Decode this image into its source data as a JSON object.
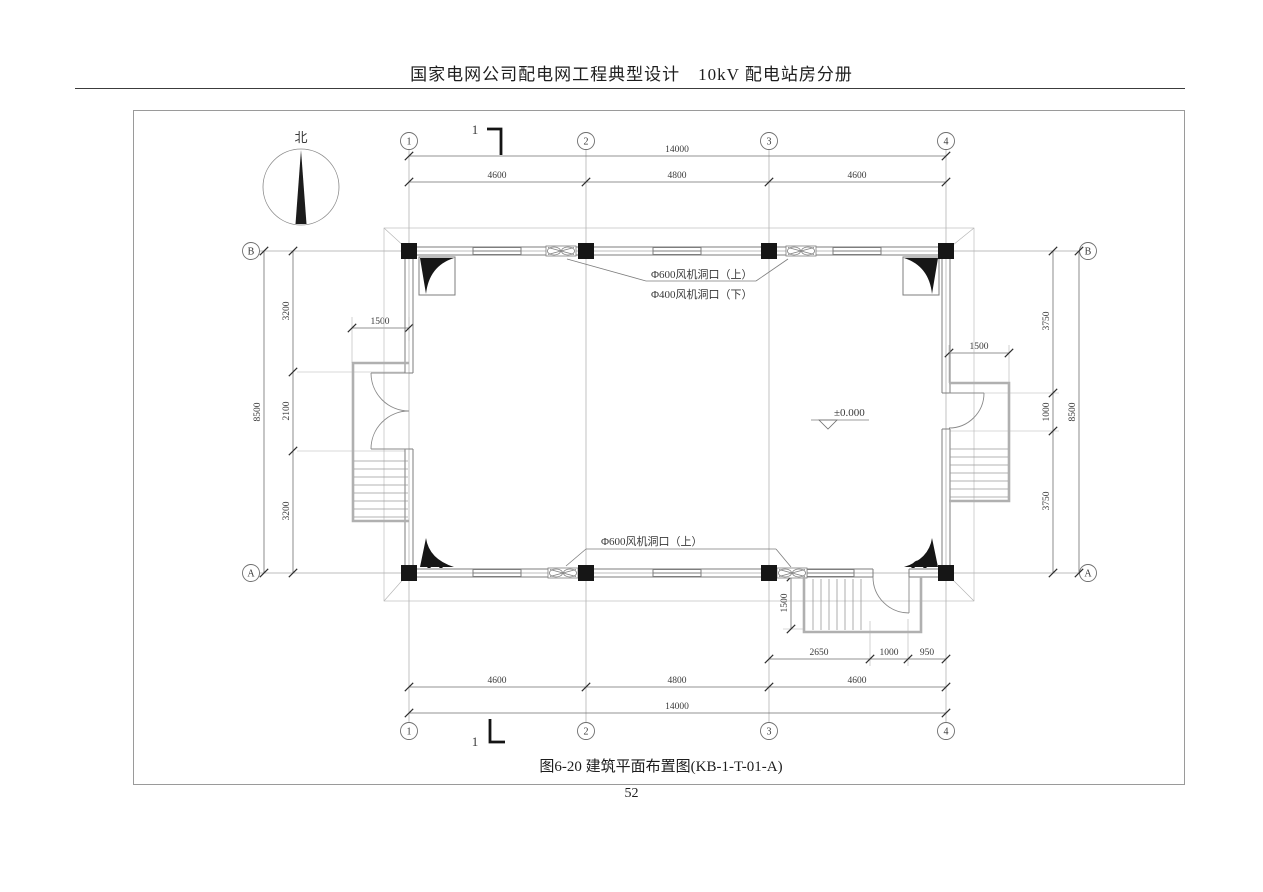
{
  "header": {
    "title": "国家电网公司配电网工程典型设计　10kV 配电站房分册"
  },
  "compass": {
    "label": "北"
  },
  "section_marker": {
    "label": "1"
  },
  "grid": {
    "columns": [
      "1",
      "2",
      "3",
      "4"
    ],
    "rows": [
      "B",
      "A"
    ]
  },
  "dimensions": {
    "top_total": "14000",
    "top_segments": [
      "4600",
      "4800",
      "4600"
    ],
    "bottom_segments": [
      "4600",
      "4800",
      "4600"
    ],
    "bottom_total": "14000",
    "left_total": "8500",
    "left_segments": [
      "3200",
      "2100",
      "3200"
    ],
    "right_total": "8500",
    "right_segments": [
      "3750",
      "1000",
      "3750"
    ],
    "left_platform_width": "1500",
    "right_platform_width": "1500",
    "bottom_platform_depth": "1500",
    "bottom_stair_segments": [
      "2650",
      "1000",
      "950"
    ]
  },
  "annotations": {
    "fan_top_line1": "Φ600风机洞口（上）",
    "fan_top_line2": "Φ400风机洞口（下）",
    "fan_bottom": "Φ600风机洞口（上）",
    "level": "±0.000"
  },
  "caption": "图6-20 建筑平面布置图(KB-1-T-01-A)",
  "page_number": "52",
  "colors": {
    "line": "#8a8a8a",
    "column": "#161616",
    "text": "#3a3a3a"
  }
}
